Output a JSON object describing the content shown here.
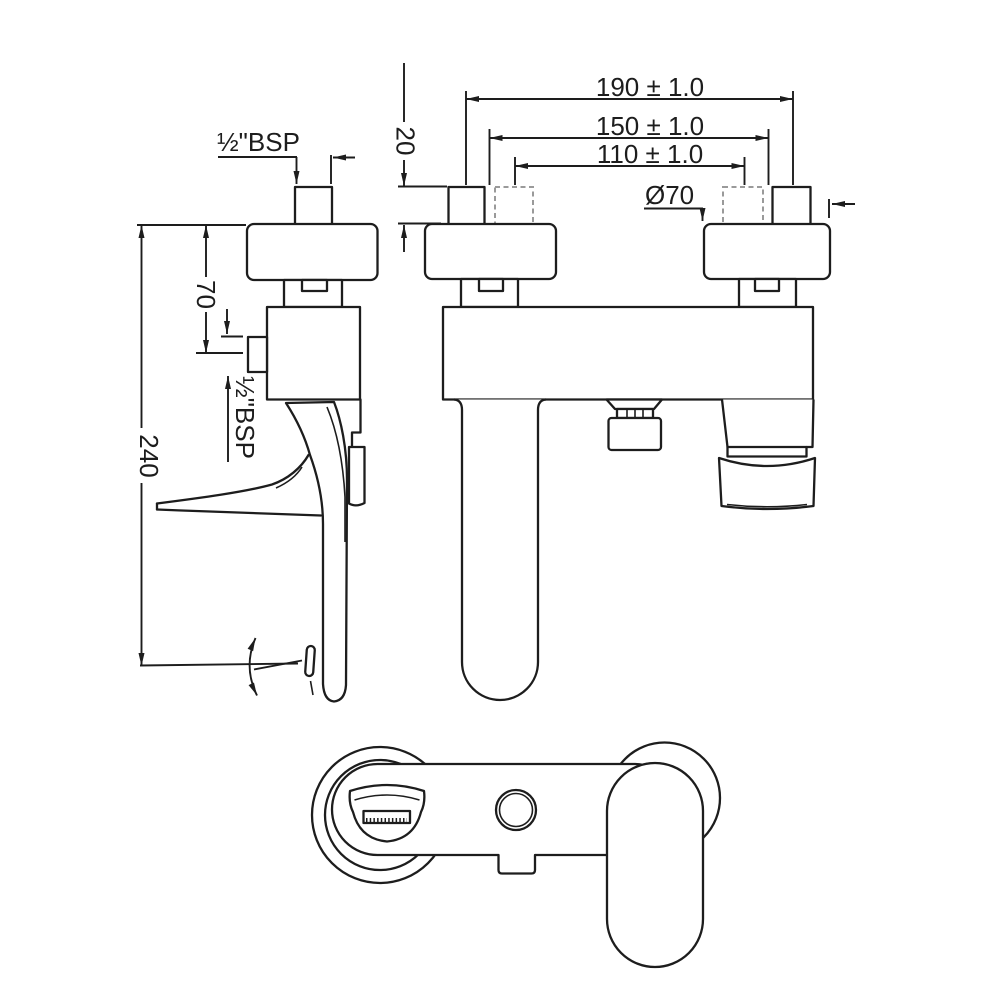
{
  "meta": {
    "type": "technical-drawing",
    "subject": "wall-mounted single lever bath shower mixer",
    "background": "#ffffff",
    "line_color": "#1d1d1d",
    "hidden_line_color": "#9a9a9a"
  },
  "side_view": {
    "inlet_thread_label": "½\"BSP",
    "outlet_thread_label": "½\"BSP",
    "flange_to_outlet_dim": "70",
    "overall_height_dim": "240"
  },
  "front_view": {
    "max_centers_dim": "190 ± 1.0",
    "nominal_centers_dim": "150 ± 1.0",
    "min_centers_dim": "110 ± 1.0",
    "nipple_projection_dim": "20",
    "flange_diameter_label": "Ø70"
  }
}
